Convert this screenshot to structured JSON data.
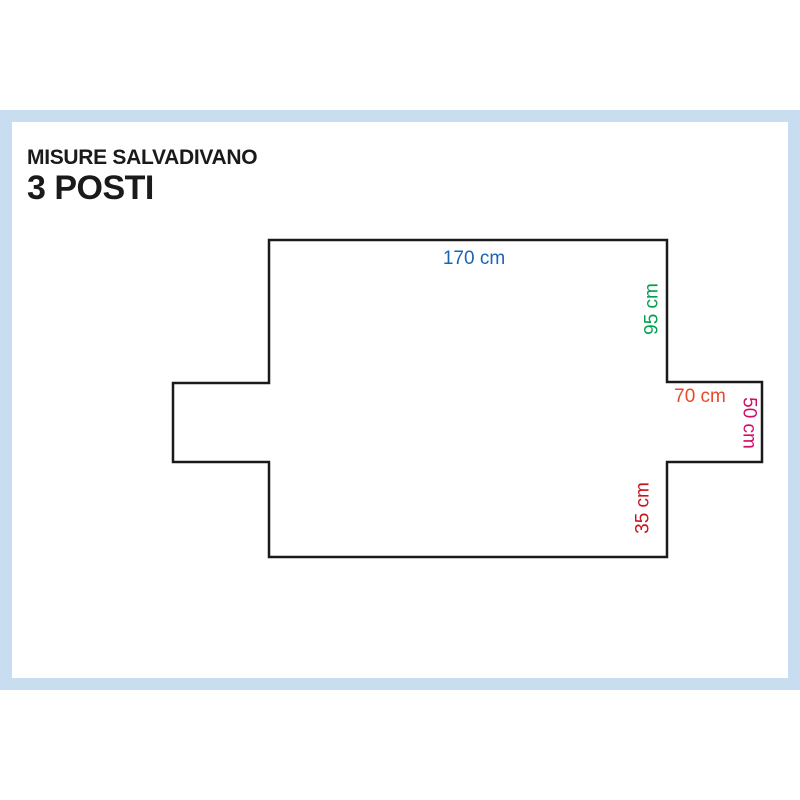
{
  "page": {
    "title_line1": "MISURE SALVADIVANO",
    "title_line2": "3 POSTI",
    "frame_color": "#c9ddf0",
    "background_color": "#ffffff"
  },
  "diagram": {
    "type": "sofa-cover-outline-flat-pattern",
    "outline_color": "#1a1a1a",
    "measurements": [
      {
        "label": "170 cm",
        "side": "top-width",
        "orientation": "horizontal",
        "color": "#1b64b1"
      },
      {
        "label": "95 cm",
        "side": "right-upper-height",
        "orientation": "vertical-up",
        "color": "#00a14e"
      },
      {
        "label": "70 cm",
        "side": "right-arm-width",
        "orientation": "horizontal",
        "color": "#e84a28"
      },
      {
        "label": "50 cm",
        "side": "right-arm-height",
        "orientation": "vertical-down",
        "color": "#cf0d6c"
      },
      {
        "label": "35 cm",
        "side": "right-lower-height",
        "orientation": "vertical-up",
        "color": "#c8161d"
      }
    ]
  }
}
